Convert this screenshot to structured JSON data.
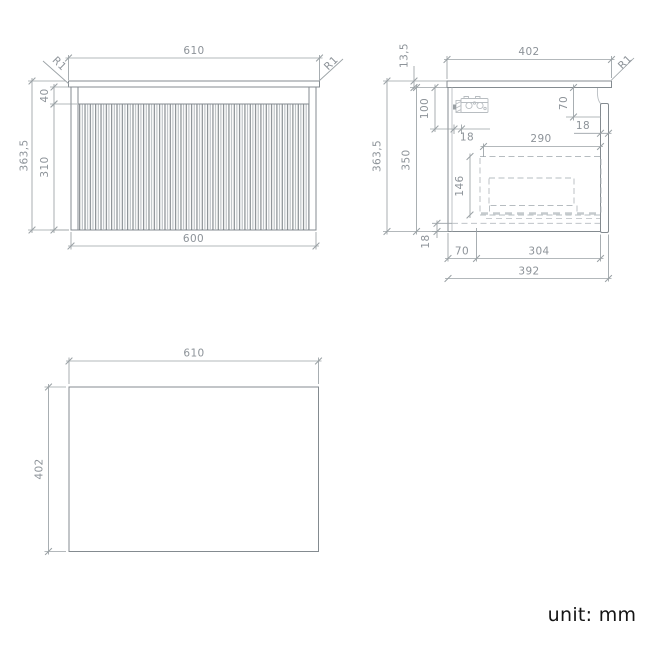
{
  "unit_note": "unit: mm",
  "front_view": {
    "countertop_width": "610",
    "cabinet_width": "600",
    "total_height": "363,5",
    "top_rail_height": "40",
    "door_height": "310",
    "corner_radius_left": "R1",
    "corner_radius_right": "R1"
  },
  "side_view": {
    "countertop_depth": "402",
    "countertop_thickness": "13,5",
    "corner_radius": "R1",
    "total_height": "363,5",
    "carcass_height": "350",
    "bracket_drop": "100",
    "bracket_inset": "18",
    "front_drop": "70",
    "door_thickness": "18",
    "drawer_depth": "290",
    "drawer_height": "146",
    "bottom_thickness": "18",
    "bottom_back_offset": "70",
    "bottom_mid_span": "304",
    "cabinet_depth": "392"
  },
  "plan_view": {
    "width": "610",
    "depth": "402"
  }
}
